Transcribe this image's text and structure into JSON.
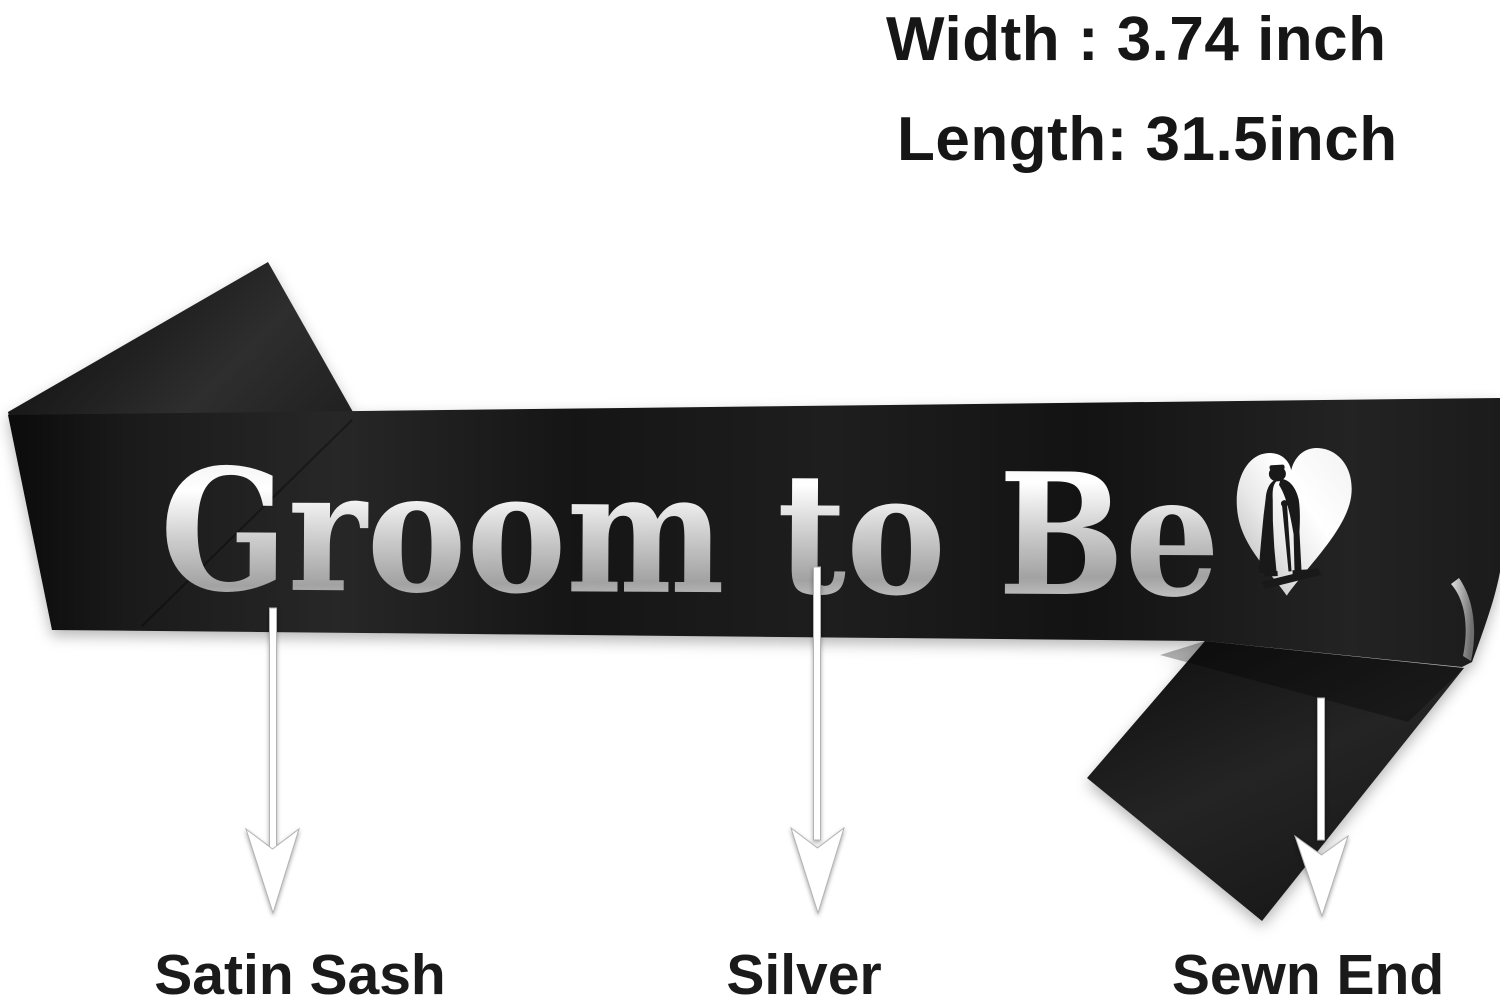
{
  "image_type": "product-annotation-photo",
  "background": "#ffffff",
  "dimensions": {
    "width_label": "Width : 3.74 inch",
    "length_label": "Length: 31.5inch"
  },
  "sash": {
    "text": "Groom to Be",
    "icon": "heart-couple-icon",
    "colors": {
      "sash_black": "#171717",
      "foil_silver": "#e8e8e8"
    }
  },
  "callouts": [
    {
      "label": "Satin Sash",
      "arrow": "down-arrow"
    },
    {
      "label": "Silver",
      "arrow": "down-arrow"
    },
    {
      "label": "Sewn End",
      "arrow": "down-arrow"
    }
  ]
}
